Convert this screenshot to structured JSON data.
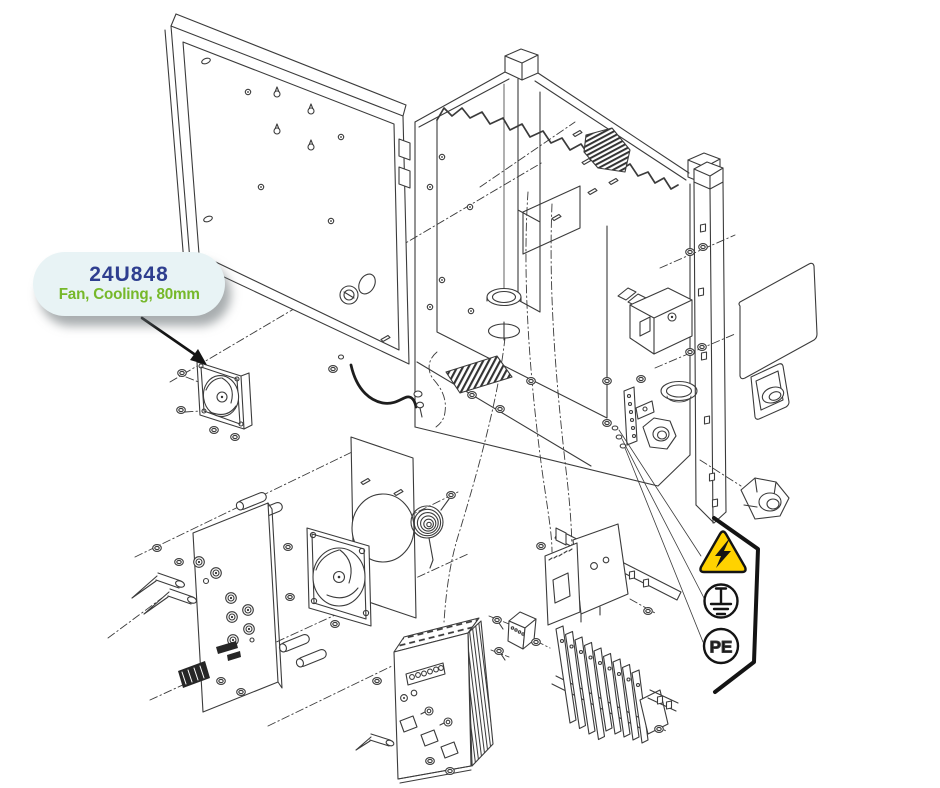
{
  "callout": {
    "part_number": "24U848",
    "description": "Fan, Cooling, 80mm",
    "part_number_color": "#2e3e8f",
    "description_color": "#76b82a",
    "bubble_bg": "#e8f3f5"
  },
  "safety_symbols": {
    "warning_icon": "high-voltage-warning-triangle-icon",
    "warning_color": "#ffd200",
    "earth_icon": "protective-earth-ground-icon",
    "pe_label": "PE"
  },
  "diagram": {
    "line_color": "#3b3b3b",
    "background": "#ffffff"
  }
}
